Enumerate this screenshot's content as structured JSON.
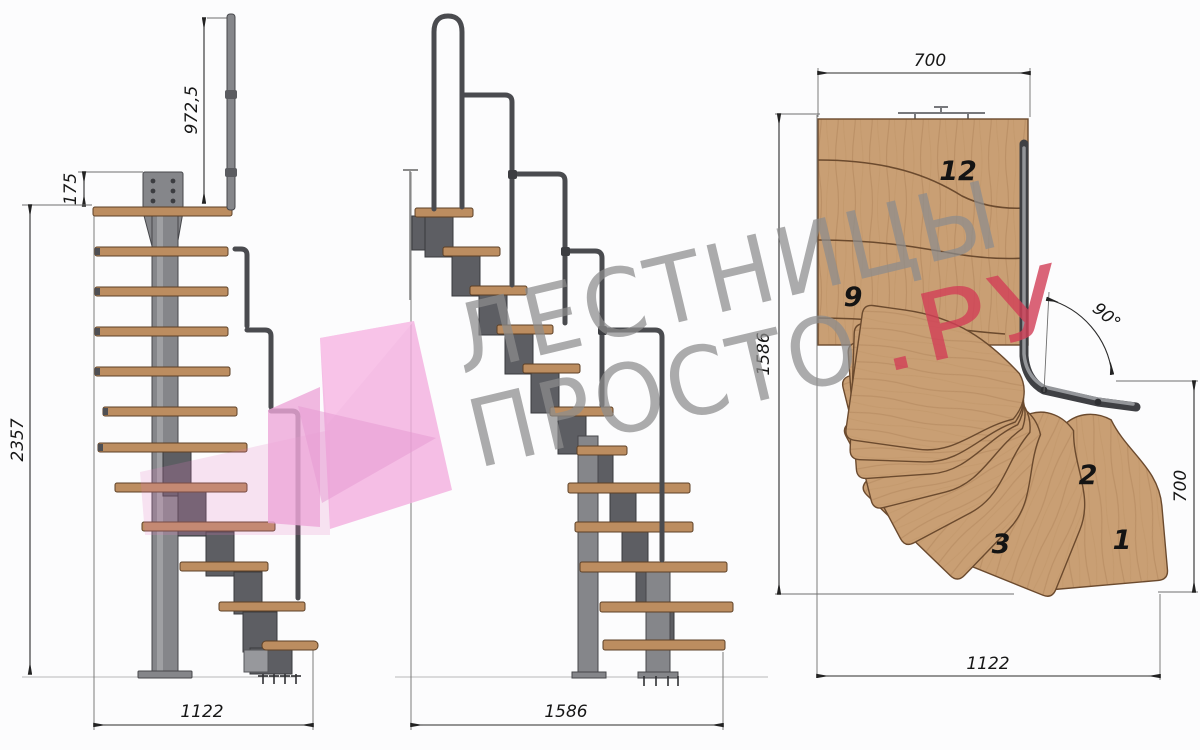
{
  "drawing": {
    "side_view": {
      "handrail_height": "972,5",
      "plate_offset": "175",
      "total_height": "2357",
      "footprint_depth": "1122"
    },
    "front_view": {
      "footprint_width": "1586"
    },
    "plan_view": {
      "width_top": "700",
      "depth_left": "1586",
      "height_right": "700",
      "width_bottom": "1122",
      "turn_angle": "90°",
      "steps": {
        "s12": "12",
        "s9": "9",
        "s3": "3",
        "s2": "2",
        "s1": "1"
      }
    },
    "watermark": {
      "word1": "ЛЕСТНИЦЫ",
      "word2": "ПРОСТО",
      "suffix": ".РУ"
    },
    "colors": {
      "wood": "#c99f74",
      "wood_edge": "#6b4a2e",
      "steel": "#85868a",
      "steel_dark": "#46474b",
      "dimension": "#2b2b2b",
      "watermark_gray": "#8d8d8d",
      "watermark_red": "#d23f57",
      "watermark_pink": "#f2aede",
      "background": "#fcfcfd"
    }
  }
}
